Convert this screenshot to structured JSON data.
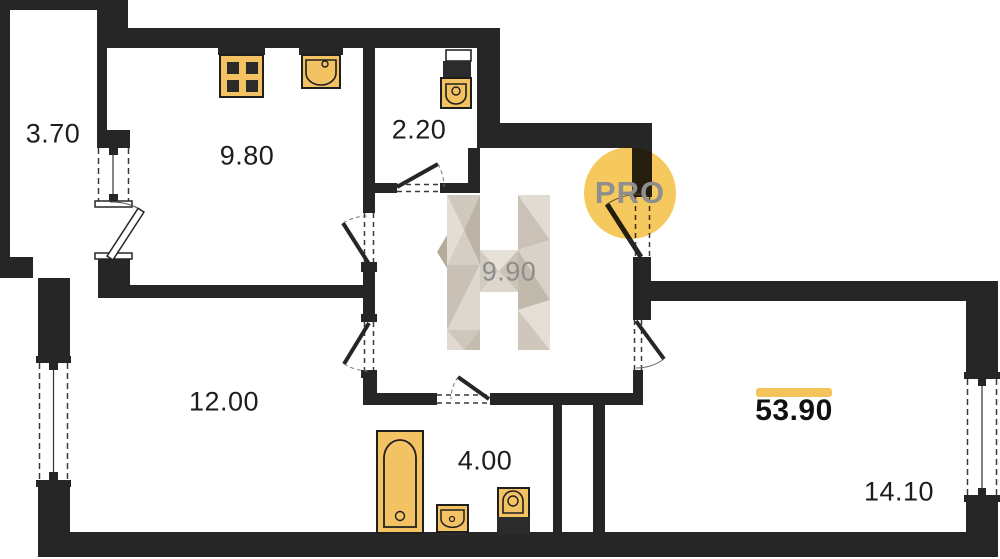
{
  "plan": {
    "rooms": [
      {
        "id": "loggia",
        "area": "3.70"
      },
      {
        "id": "kitchen",
        "area": "9.80"
      },
      {
        "id": "bathroom-small",
        "area": "2.20"
      },
      {
        "id": "hallway",
        "area": "9.90"
      },
      {
        "id": "room-left",
        "area": "12.00"
      },
      {
        "id": "bathroom",
        "area": "4.00"
      },
      {
        "id": "room-right",
        "area": "14.10"
      }
    ],
    "total_area": "53.90",
    "watermark": {
      "badge": "PRO",
      "logo_letter": "H"
    },
    "fixtures": [
      "stove",
      "kitchen-sink",
      "toilet",
      "bathtub",
      "washbasin",
      "toilet"
    ],
    "colors": {
      "wall": "#262626",
      "fixture_fill": "#f3c363",
      "accent_bar": "#f5c35c",
      "badge_circle": "#f6c550",
      "hallway_label": "#8d8d8d"
    }
  }
}
